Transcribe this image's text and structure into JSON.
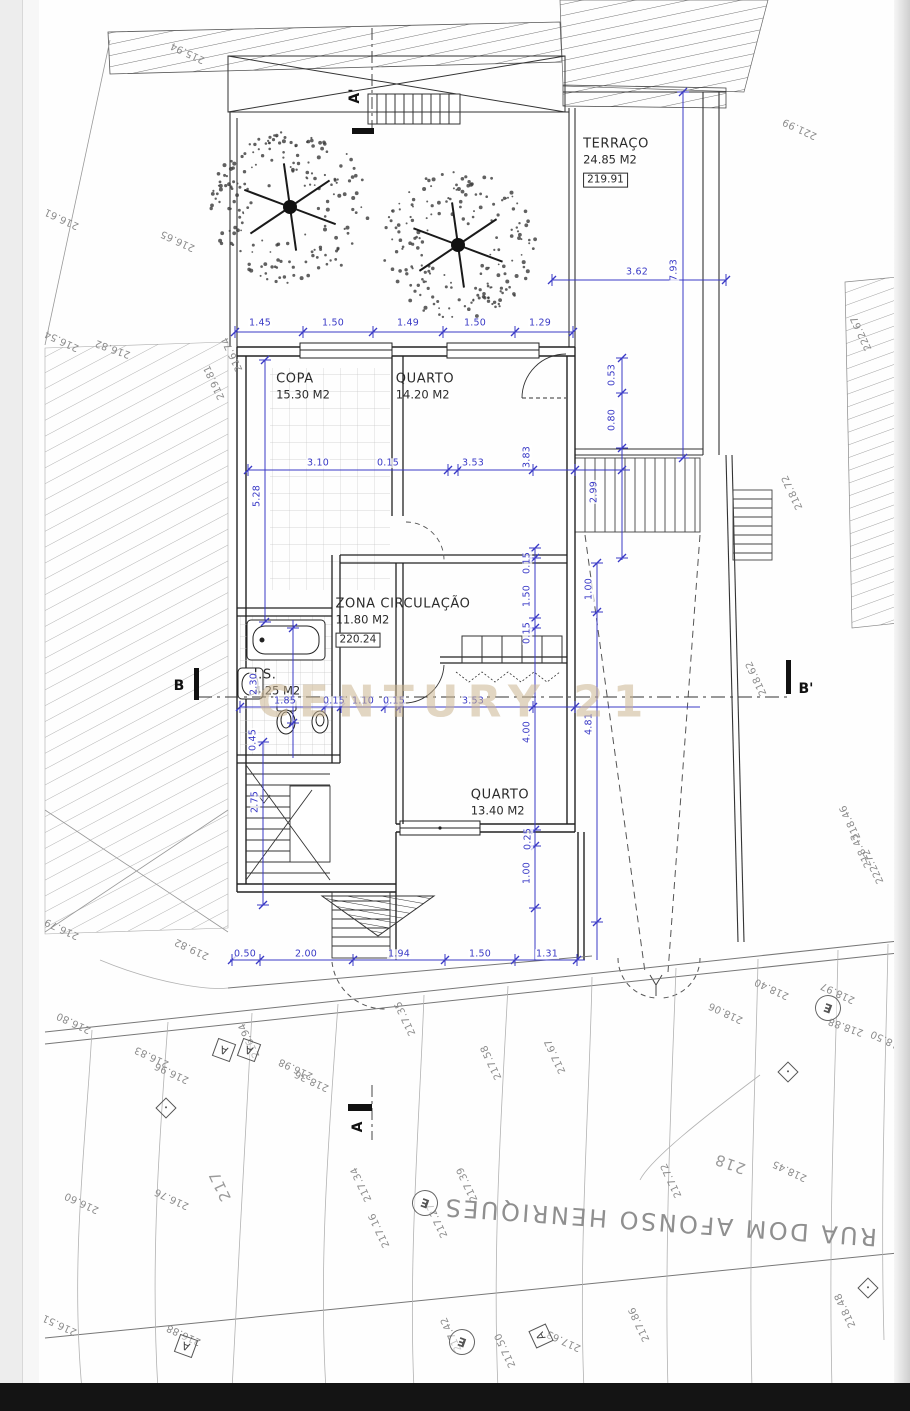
{
  "labels": {
    "watermark": "CENTURY 21",
    "street": "RUA DOM AFONSO HENRIQUES",
    "copyright": "Este projecto é propriedade intelectual do seu Autor, não podendo ser usado para qualquer propósito, a não ser o aqui expresso, sem prévia autorização conforme a Lei n.º 50/04 de 24 de Agosto do Código dos Direitos de Autor e Direitos Conexos."
  },
  "colors": {
    "dimension_blue": "#3a3ac6",
    "drawing_line": "#2a2a2a",
    "elevation_gray": "#8c8c8c",
    "watermark_gold": "#cab48f"
  },
  "rooms": [
    {
      "nm": "TERRAÇO",
      "ar": "24.85 M2",
      "lv": "219.91",
      "x": 616,
      "y": 162
    },
    {
      "nm": "COPA",
      "ar": "15.30 M2",
      "lv": "",
      "x": 303,
      "y": 387
    },
    {
      "nm": "QUARTO",
      "ar": "14.20 M2",
      "lv": "",
      "x": 425,
      "y": 387
    },
    {
      "nm": "ZONA CIRCULAÇÃO",
      "ar": "11.80 M2",
      "lv": "220.24",
      "x": 403,
      "y": 622
    },
    {
      "nm": "I.S.",
      "ar": "4.25 M2",
      "lv": "",
      "x": 277,
      "y": 683
    },
    {
      "nm": "QUARTO",
      "ar": "13.40 M2",
      "lv": "",
      "x": 500,
      "y": 803
    }
  ],
  "sections": [
    {
      "v": "A'",
      "x": 355,
      "y": 96,
      "rot": -90
    },
    {
      "v": "A",
      "x": 358,
      "y": 1127,
      "rot": -90
    },
    {
      "v": "B",
      "x": 179,
      "y": 686,
      "rot": 0
    },
    {
      "v": "B'",
      "x": 806,
      "y": 689,
      "rot": 0
    }
  ],
  "dimensions": [
    {
      "v": "1.45",
      "x": 260,
      "y": 323,
      "rot": 0
    },
    {
      "v": "1.50",
      "x": 333,
      "y": 323,
      "rot": 0
    },
    {
      "v": "1.49",
      "x": 408,
      "y": 323,
      "rot": 0
    },
    {
      "v": "1.50",
      "x": 475,
      "y": 323,
      "rot": 0
    },
    {
      "v": "1.29",
      "x": 540,
      "y": 323,
      "rot": 0
    },
    {
      "v": "3.62",
      "x": 637,
      "y": 272,
      "rot": 0
    },
    {
      "v": "7.93",
      "x": 674,
      "y": 270,
      "rot": -90
    },
    {
      "v": "3.10",
      "x": 318,
      "y": 463,
      "rot": 0
    },
    {
      "v": "0.15",
      "x": 388,
      "y": 463,
      "rot": 0
    },
    {
      "v": "3.53",
      "x": 473,
      "y": 463,
      "rot": 0
    },
    {
      "v": "3.83",
      "x": 527,
      "y": 457,
      "rot": -90
    },
    {
      "v": "5.28",
      "x": 257,
      "y": 496,
      "rot": -90
    },
    {
      "v": "0.53",
      "x": 612,
      "y": 375,
      "rot": -90
    },
    {
      "v": "0.80",
      "x": 612,
      "y": 420,
      "rot": -90
    },
    {
      "v": "2.99",
      "x": 594,
      "y": 492,
      "rot": -90
    },
    {
      "v": "0.15",
      "x": 527,
      "y": 563,
      "rot": -90
    },
    {
      "v": "1.50",
      "x": 527,
      "y": 596,
      "rot": -90
    },
    {
      "v": "0.15",
      "x": 527,
      "y": 633,
      "rot": -90
    },
    {
      "v": "1.00",
      "x": 589,
      "y": 589,
      "rot": -90
    },
    {
      "v": "4.00",
      "x": 527,
      "y": 732,
      "rot": -90
    },
    {
      "v": "4.81",
      "x": 589,
      "y": 724,
      "rot": -90
    },
    {
      "v": "0.25",
      "x": 528,
      "y": 839,
      "rot": -90
    },
    {
      "v": "1.00",
      "x": 527,
      "y": 873,
      "rot": -90
    },
    {
      "v": "2.30",
      "x": 254,
      "y": 684,
      "rot": -90
    },
    {
      "v": "0.45",
      "x": 253,
      "y": 740,
      "rot": -90
    },
    {
      "v": "2.75",
      "x": 255,
      "y": 802,
      "rot": -90
    },
    {
      "v": "1.85",
      "x": 285,
      "y": 701,
      "rot": 0
    },
    {
      "v": "0.15",
      "x": 334,
      "y": 701,
      "rot": 0
    },
    {
      "v": "1.10",
      "x": 363,
      "y": 701,
      "rot": 0
    },
    {
      "v": "0.15",
      "x": 394,
      "y": 701,
      "rot": 0
    },
    {
      "v": "3.53",
      "x": 473,
      "y": 701,
      "rot": 0
    },
    {
      "v": "0.50",
      "x": 245,
      "y": 954,
      "rot": 0
    },
    {
      "v": "2.00",
      "x": 306,
      "y": 954,
      "rot": 0
    },
    {
      "v": "1.94",
      "x": 399,
      "y": 954,
      "rot": 0
    },
    {
      "v": "1.50",
      "x": 480,
      "y": 954,
      "rot": 0
    },
    {
      "v": "1.31",
      "x": 547,
      "y": 954,
      "rot": 0
    }
  ],
  "elevations": [
    {
      "v": "215.94",
      "x": 188,
      "y": 52,
      "rot": 205
    },
    {
      "v": "216.61",
      "x": 62,
      "y": 218,
      "rot": 205
    },
    {
      "v": "216.65",
      "x": 178,
      "y": 240,
      "rot": 205
    },
    {
      "v": "216.54",
      "x": 62,
      "y": 340,
      "rot": 205
    },
    {
      "v": "216.82",
      "x": 113,
      "y": 348,
      "rot": 200
    },
    {
      "v": "216.74",
      "x": 233,
      "y": 354,
      "rot": 245
    },
    {
      "v": "219.81",
      "x": 215,
      "y": 382,
      "rot": 245
    },
    {
      "v": "221.99",
      "x": 800,
      "y": 128,
      "rot": 205
    },
    {
      "v": "222.67",
      "x": 862,
      "y": 333,
      "rot": 245
    },
    {
      "v": "218.72",
      "x": 793,
      "y": 492,
      "rot": 245
    },
    {
      "v": "218.62",
      "x": 757,
      "y": 678,
      "rot": 245
    },
    {
      "v": "218.46",
      "x": 851,
      "y": 822,
      "rot": 245
    },
    {
      "v": "218.43",
      "x": 862,
      "y": 850,
      "rot": 245
    },
    {
      "v": "222.72",
      "x": 874,
      "y": 866,
      "rot": 245
    },
    {
      "v": "216.79",
      "x": 62,
      "y": 928,
      "rot": 205
    },
    {
      "v": "219.82",
      "x": 192,
      "y": 948,
      "rot": 205
    },
    {
      "v": "216.80",
      "x": 74,
      "y": 1022,
      "rot": 205
    },
    {
      "v": "216.83",
      "x": 152,
      "y": 1056,
      "rot": 205
    },
    {
      "v": "216.96",
      "x": 172,
      "y": 1072,
      "rot": 205
    },
    {
      "v": "216.94",
      "x": 250,
      "y": 1040,
      "rot": 245
    },
    {
      "v": "216.98",
      "x": 296,
      "y": 1068,
      "rot": 205
    },
    {
      "v": "218.36",
      "x": 312,
      "y": 1080,
      "rot": 205
    },
    {
      "v": "217.35",
      "x": 406,
      "y": 1018,
      "rot": 245
    },
    {
      "v": "217.58",
      "x": 492,
      "y": 1062,
      "rot": 245
    },
    {
      "v": "217.67",
      "x": 556,
      "y": 1056,
      "rot": 245
    },
    {
      "v": "218.06",
      "x": 726,
      "y": 1012,
      "rot": 205
    },
    {
      "v": "218.40",
      "x": 772,
      "y": 988,
      "rot": 205
    },
    {
      "v": "218.97",
      "x": 838,
      "y": 992,
      "rot": 205
    },
    {
      "v": "218.88",
      "x": 846,
      "y": 1026,
      "rot": 200
    },
    {
      "v": "218.50",
      "x": 888,
      "y": 1040,
      "rot": 205
    },
    {
      "v": "217.34",
      "x": 362,
      "y": 1184,
      "rot": 245
    },
    {
      "v": "217.16",
      "x": 380,
      "y": 1230,
      "rot": 245
    },
    {
      "v": "217.27",
      "x": 438,
      "y": 1220,
      "rot": 245
    },
    {
      "v": "217.39",
      "x": 468,
      "y": 1184,
      "rot": 245
    },
    {
      "v": "217.72",
      "x": 672,
      "y": 1180,
      "rot": 245
    },
    {
      "v": "218.45",
      "x": 790,
      "y": 1170,
      "rot": 205
    },
    {
      "v": "216.76",
      "x": 172,
      "y": 1198,
      "rot": 205
    },
    {
      "v": "216.60",
      "x": 82,
      "y": 1202,
      "rot": 205
    },
    {
      "v": "216.51",
      "x": 60,
      "y": 1324,
      "rot": 205
    },
    {
      "v": "216.88",
      "x": 184,
      "y": 1334,
      "rot": 205
    },
    {
      "v": "217.86",
      "x": 640,
      "y": 1324,
      "rot": 245
    },
    {
      "v": "217.42",
      "x": 452,
      "y": 1334,
      "rot": 245
    },
    {
      "v": "217.63",
      "x": 564,
      "y": 1340,
      "rot": 205
    },
    {
      "v": "217.50",
      "x": 506,
      "y": 1350,
      "rot": 245
    },
    {
      "v": "218.48",
      "x": 846,
      "y": 1310,
      "rot": 245
    }
  ],
  "contour_labels": [
    {
      "v": "217",
      "x": 220,
      "y": 1186,
      "rot": 245
    },
    {
      "v": "218",
      "x": 730,
      "y": 1164,
      "rot": 200
    }
  ],
  "e_markers": [
    {
      "v": "E",
      "x": 425,
      "y": 1203,
      "rot": 200
    },
    {
      "v": "E",
      "x": 462,
      "y": 1342,
      "rot": 200
    },
    {
      "v": "E",
      "x": 828,
      "y": 1008,
      "rot": 200
    }
  ],
  "a_markers": [
    {
      "v": "A",
      "x": 224,
      "y": 1050,
      "rot": 200
    },
    {
      "v": "A",
      "x": 249,
      "y": 1050,
      "rot": 200
    },
    {
      "v": "A",
      "x": 186,
      "y": 1346,
      "rot": 200
    },
    {
      "v": "A",
      "x": 541,
      "y": 1336,
      "rot": 245
    }
  ],
  "diamond_markers": [
    {
      "x": 166,
      "y": 1108,
      "rot": 45
    },
    {
      "x": 788,
      "y": 1072,
      "rot": 45
    },
    {
      "x": 868,
      "y": 1288,
      "rot": 45
    }
  ]
}
